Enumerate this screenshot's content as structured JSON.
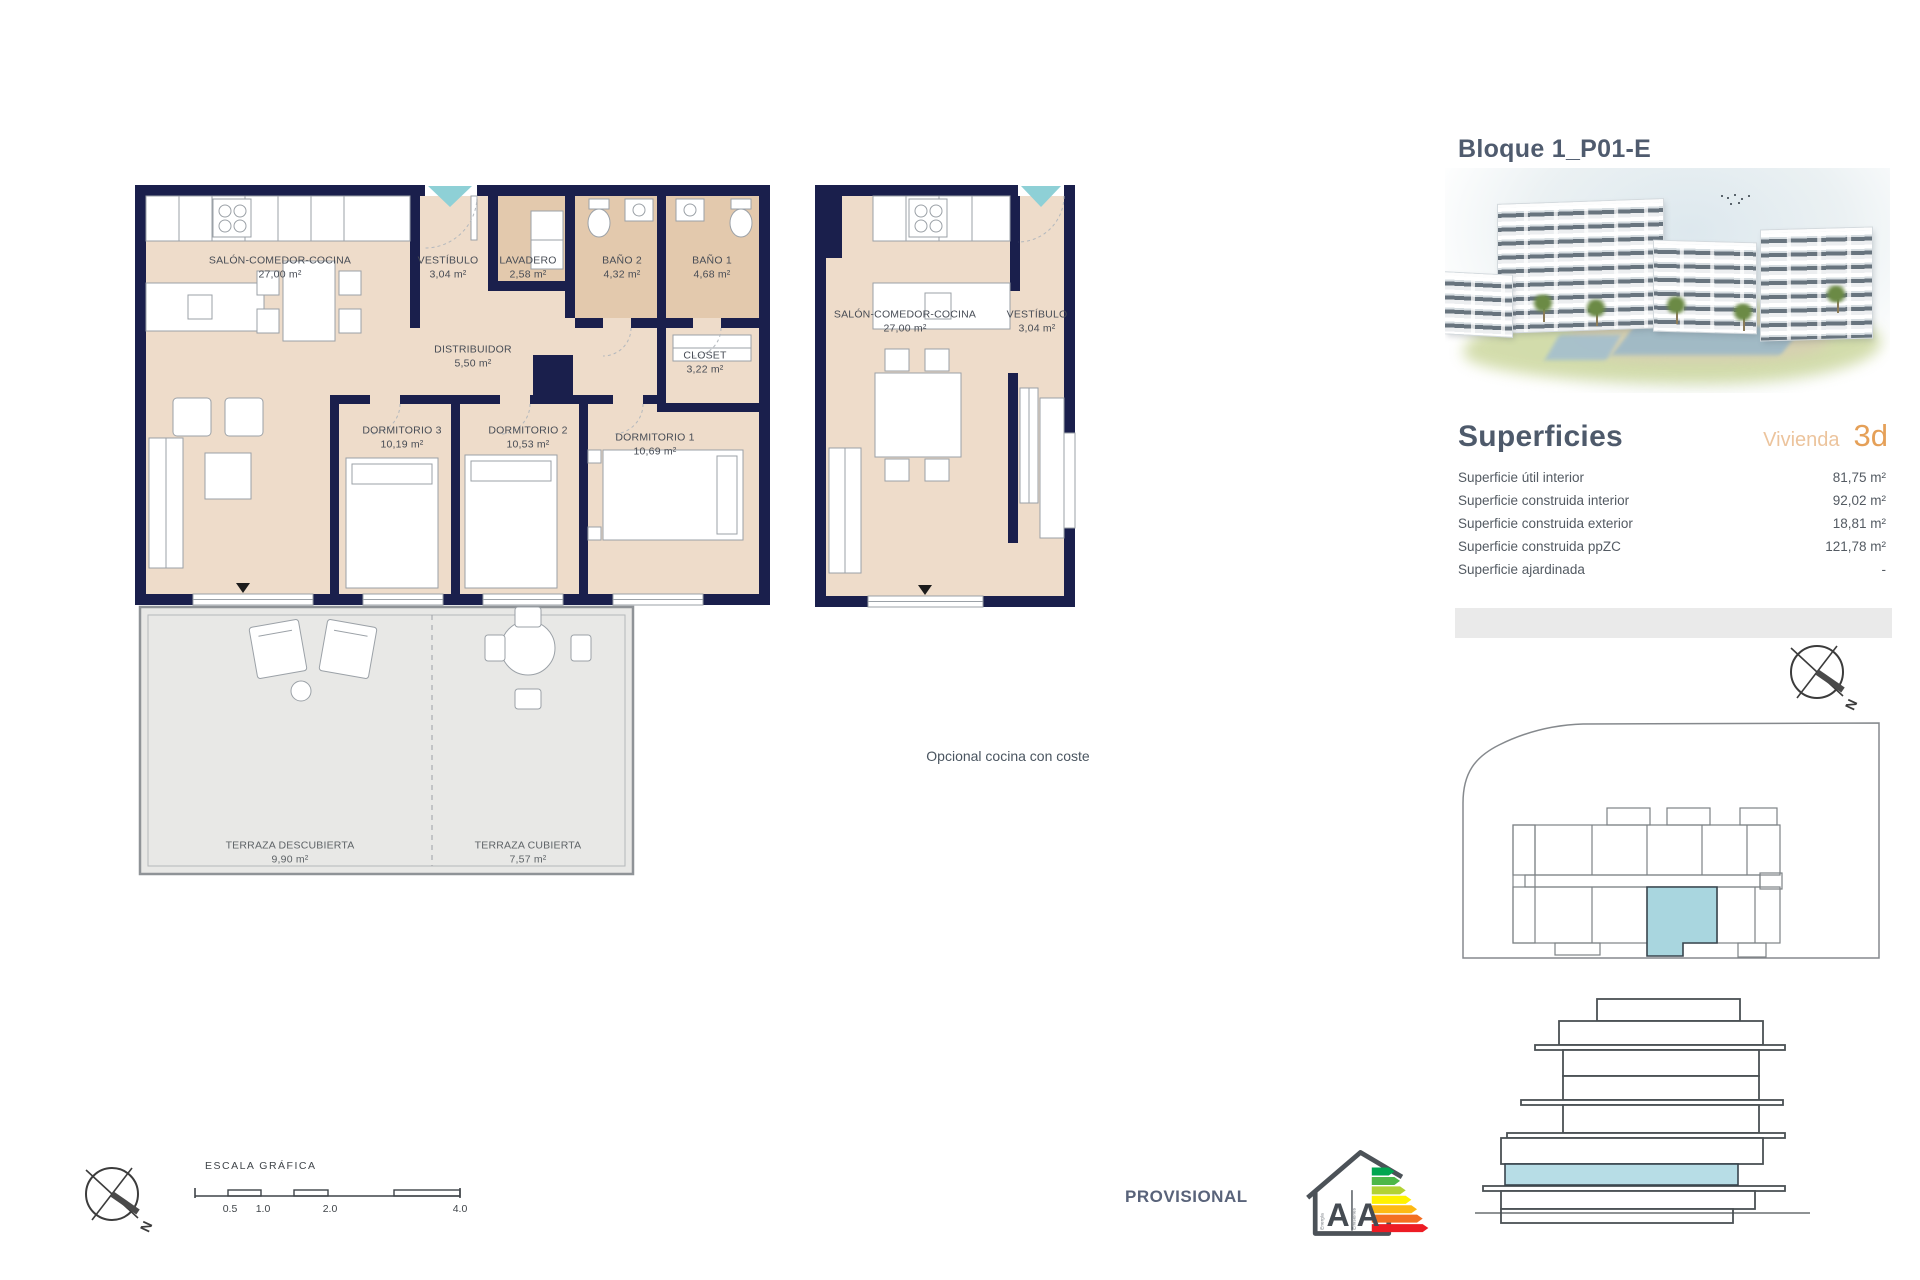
{
  "header": {
    "title": "Bloque 1_P01-E"
  },
  "plan_main": {
    "rooms": {
      "salon": {
        "name": "SALÓN-COMEDOR-COCINA",
        "area": "27,00 m²"
      },
      "vestibulo": {
        "name": "VESTÍBULO",
        "area": "3,04 m²"
      },
      "lavadero": {
        "name": "LAVADERO",
        "area": "2,58 m²"
      },
      "bano2": {
        "name": "BAÑO 2",
        "area": "4,32 m²"
      },
      "bano1": {
        "name": "BAÑO 1",
        "area": "4,68 m²"
      },
      "distribuidor": {
        "name": "DISTRIBUIDOR",
        "area": "5,50 m²"
      },
      "closet": {
        "name": "CLOSET",
        "area": "3,22 m²"
      },
      "dormitorio3": {
        "name": "DORMITORIO 3",
        "area": "10,19 m²"
      },
      "dormitorio2": {
        "name": "DORMITORIO 2",
        "area": "10,53 m²"
      },
      "dormitorio1": {
        "name": "DORMITORIO 1",
        "area": "10,69 m²"
      },
      "terraza_descubierta": {
        "name": "TERRAZA DESCUBIERTA",
        "area": "9,90 m²"
      },
      "terraza_cubierta": {
        "name": "TERRAZA CUBIERTA",
        "area": "7,57 m²"
      }
    }
  },
  "plan_optional": {
    "rooms": {
      "salon": {
        "name": "SALÓN-COMEDOR-COCINA",
        "area": "27,00 m²"
      },
      "vestibulo": {
        "name": "VESTÍBULO",
        "area": "3,04 m²"
      }
    },
    "caption": "Opcional cocina con coste"
  },
  "superficies": {
    "heading": "Superficies",
    "vivienda_label": "Vivienda",
    "vivienda_code": "3d",
    "rows": [
      {
        "label": "Superficie útil interior",
        "value": "81,75 m²"
      },
      {
        "label": "Superficie construida interior",
        "value": "92,02 m²"
      },
      {
        "label": "Superficie construida exterior",
        "value": "18,81 m²"
      },
      {
        "label": "Superficie construida ppZC",
        "value": "121,78 m²"
      },
      {
        "label": "Superficie ajardinada",
        "value": "-"
      }
    ]
  },
  "scale": {
    "label": "ESCALA GRÁFICA",
    "ticks": [
      "0.5",
      "1.0",
      "2.0",
      "4.0"
    ]
  },
  "compass": {
    "north": "N"
  },
  "footer": {
    "provisional": "PROVISIONAL"
  },
  "energy_label": {
    "letter_left": "A",
    "letter_right": "A",
    "word_left": "Energía",
    "word_right": "Emisiones"
  },
  "colors": {
    "wall_navy": "#1a1f4c",
    "floor_beige": "#eedcca",
    "wet_room_tan": "#e3c9ad",
    "terrace_gray": "#e8e8e6",
    "entry_teal": "#8ed0d6",
    "unit_highlight_blue": "#a9d6df",
    "heading_slate": "#4e5a6b",
    "accent_orange": "#e5a058"
  }
}
